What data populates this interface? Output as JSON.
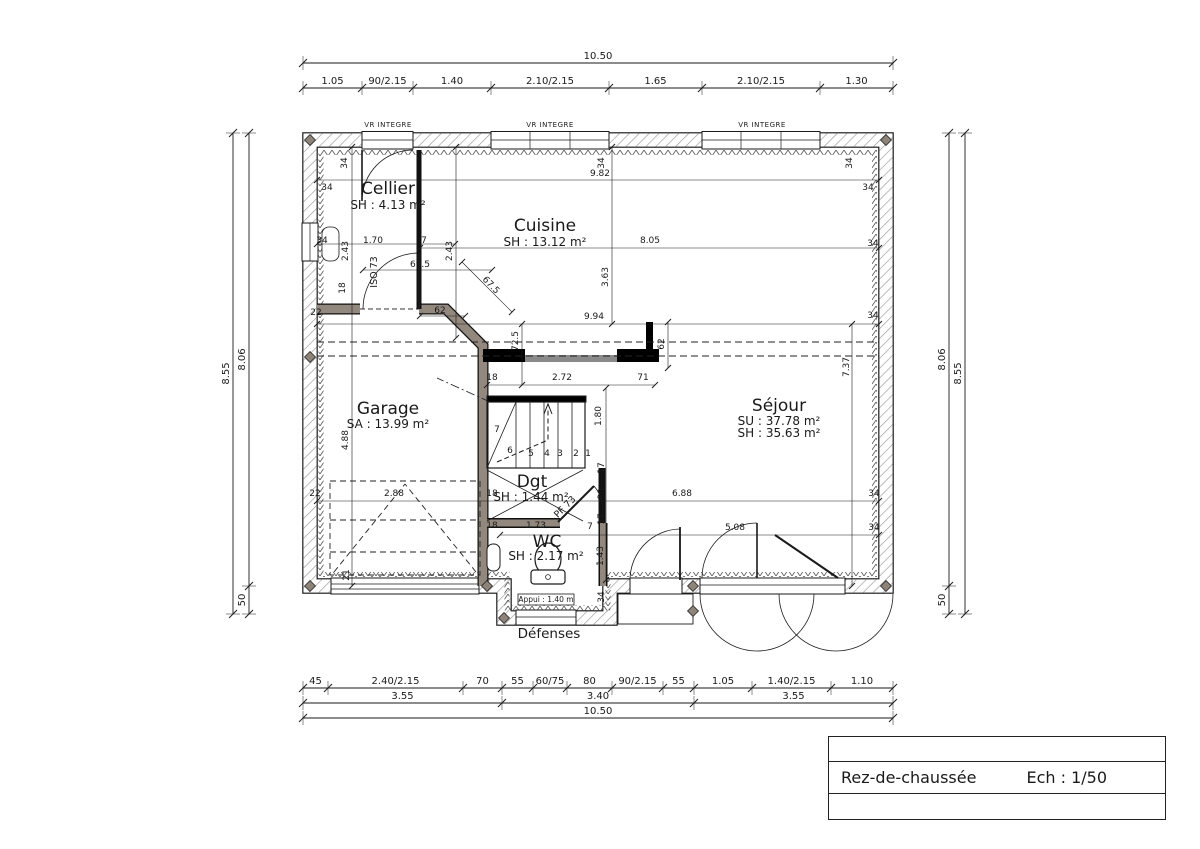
{
  "title_block": {
    "name": "Rez-de-chaussée",
    "scale": "Ech : 1/50"
  },
  "plan": {
    "rooms": [
      {
        "name": "Cellier",
        "area": "SH : 4.13 m²"
      },
      {
        "name": "Cuisine",
        "area": "SH : 13.12 m²"
      },
      {
        "name": "Garage",
        "area": "SA : 13.99 m²"
      },
      {
        "name": "Séjour",
        "area_su": "SU : 37.78 m²",
        "area_sh": "SH : 35.63 m²"
      },
      {
        "name": "Dgt",
        "area": "SH : 1.44 m²"
      },
      {
        "name": "WC",
        "area": "SH : 2.17 m²"
      }
    ],
    "window_label": "VR INTEGRE",
    "door_cellier": "ISO 73",
    "door_dgt": "PF 73",
    "defenses": "Défenses",
    "sill": "Appui : 1.40 m",
    "annotations": [
      {
        "t": "9.82",
        "x": 600,
        "y": 176
      },
      {
        "t": "34",
        "x": 327,
        "y": 190
      },
      {
        "t": "34",
        "x": 868,
        "y": 190
      },
      {
        "t": "34",
        "x": 347,
        "y": 163,
        "r": -90
      },
      {
        "t": "34",
        "x": 604,
        "y": 163,
        "r": -90
      },
      {
        "t": "34",
        "x": 852,
        "y": 163,
        "r": -90
      },
      {
        "t": "34",
        "x": 873,
        "y": 246
      },
      {
        "t": "8.05",
        "x": 650,
        "y": 243
      },
      {
        "t": "3.63",
        "x": 608,
        "y": 277,
        "r": -90
      },
      {
        "t": "2.43",
        "x": 348,
        "y": 251,
        "r": -90
      },
      {
        "t": "2.43",
        "x": 452,
        "y": 251,
        "r": -90
      },
      {
        "t": "1.70",
        "x": 373,
        "y": 243
      },
      {
        "t": "7",
        "x": 424,
        "y": 243
      },
      {
        "t": "34",
        "x": 322,
        "y": 243
      },
      {
        "t": "18",
        "x": 345,
        "y": 288,
        "r": -90
      },
      {
        "t": "69.5",
        "x": 420,
        "y": 267
      },
      {
        "t": "67.5",
        "x": 489,
        "y": 287,
        "r": 46
      },
      {
        "t": "62",
        "x": 440,
        "y": 313
      },
      {
        "t": "22",
        "x": 316,
        "y": 315
      },
      {
        "t": "34",
        "x": 873,
        "y": 318
      },
      {
        "t": "9.94",
        "x": 594,
        "y": 319
      },
      {
        "t": "72.5",
        "x": 518,
        "y": 341,
        "r": -90
      },
      {
        "t": "62",
        "x": 664,
        "y": 344,
        "r": -90
      },
      {
        "t": "2.72",
        "x": 562,
        "y": 380
      },
      {
        "t": "18",
        "x": 492,
        "y": 380
      },
      {
        "t": "71",
        "x": 643,
        "y": 380
      },
      {
        "t": "7.37",
        "x": 849,
        "y": 367,
        "r": -90
      },
      {
        "t": "1.80",
        "x": 601,
        "y": 416,
        "r": -90
      },
      {
        "t": "4.88",
        "x": 348,
        "y": 440,
        "r": -90
      },
      {
        "t": "7",
        "x": 497,
        "y": 432
      },
      {
        "t": "6",
        "x": 510,
        "y": 453
      },
      {
        "t": "5",
        "x": 531,
        "y": 456
      },
      {
        "t": "4",
        "x": 547,
        "y": 456
      },
      {
        "t": "3",
        "x": 560,
        "y": 456
      },
      {
        "t": "2",
        "x": 576,
        "y": 456
      },
      {
        "t": "1",
        "x": 588,
        "y": 456
      },
      {
        "t": "17",
        "x": 604,
        "y": 468,
        "r": -90
      },
      {
        "t": "2.88",
        "x": 394,
        "y": 496
      },
      {
        "t": "22",
        "x": 315,
        "y": 496
      },
      {
        "t": "18",
        "x": 492,
        "y": 496
      },
      {
        "t": "80",
        "x": 604,
        "y": 494,
        "r": -90
      },
      {
        "t": "6.88",
        "x": 682,
        "y": 496
      },
      {
        "t": "34",
        "x": 874,
        "y": 496
      },
      {
        "t": "17",
        "x": 604,
        "y": 519,
        "r": -90
      },
      {
        "t": "1.73",
        "x": 536,
        "y": 528
      },
      {
        "t": "7",
        "x": 590,
        "y": 529
      },
      {
        "t": "18",
        "x": 492,
        "y": 528
      },
      {
        "t": "5.08",
        "x": 735,
        "y": 530
      },
      {
        "t": "34",
        "x": 874,
        "y": 530
      },
      {
        "t": "1.43",
        "x": 603,
        "y": 556,
        "r": -90
      },
      {
        "t": "21",
        "x": 349,
        "y": 575,
        "r": -90
      },
      {
        "t": "34",
        "x": 604,
        "y": 597,
        "r": -90
      }
    ]
  },
  "dims": {
    "top": {
      "total": "10.50",
      "segments": [
        "1.05",
        "90/2.15",
        "1.40",
        "2.10/2.15",
        "1.65",
        "2.10/2.15",
        "1.30"
      ]
    },
    "bottom": {
      "row1": [
        "45",
        "2.40/2.15",
        "70",
        "55",
        "60/75",
        "80",
        "90/2.15",
        "55",
        "1.05",
        "1.40/2.15",
        "1.10"
      ],
      "row2": [
        "3.55",
        "3.40",
        "3.55"
      ],
      "total": "10.50"
    },
    "left": {
      "outer": "8.55",
      "inner": [
        "8.06",
        "50"
      ]
    },
    "right": {
      "inner": [
        "8.06",
        "50"
      ],
      "outer": "8.55"
    }
  }
}
